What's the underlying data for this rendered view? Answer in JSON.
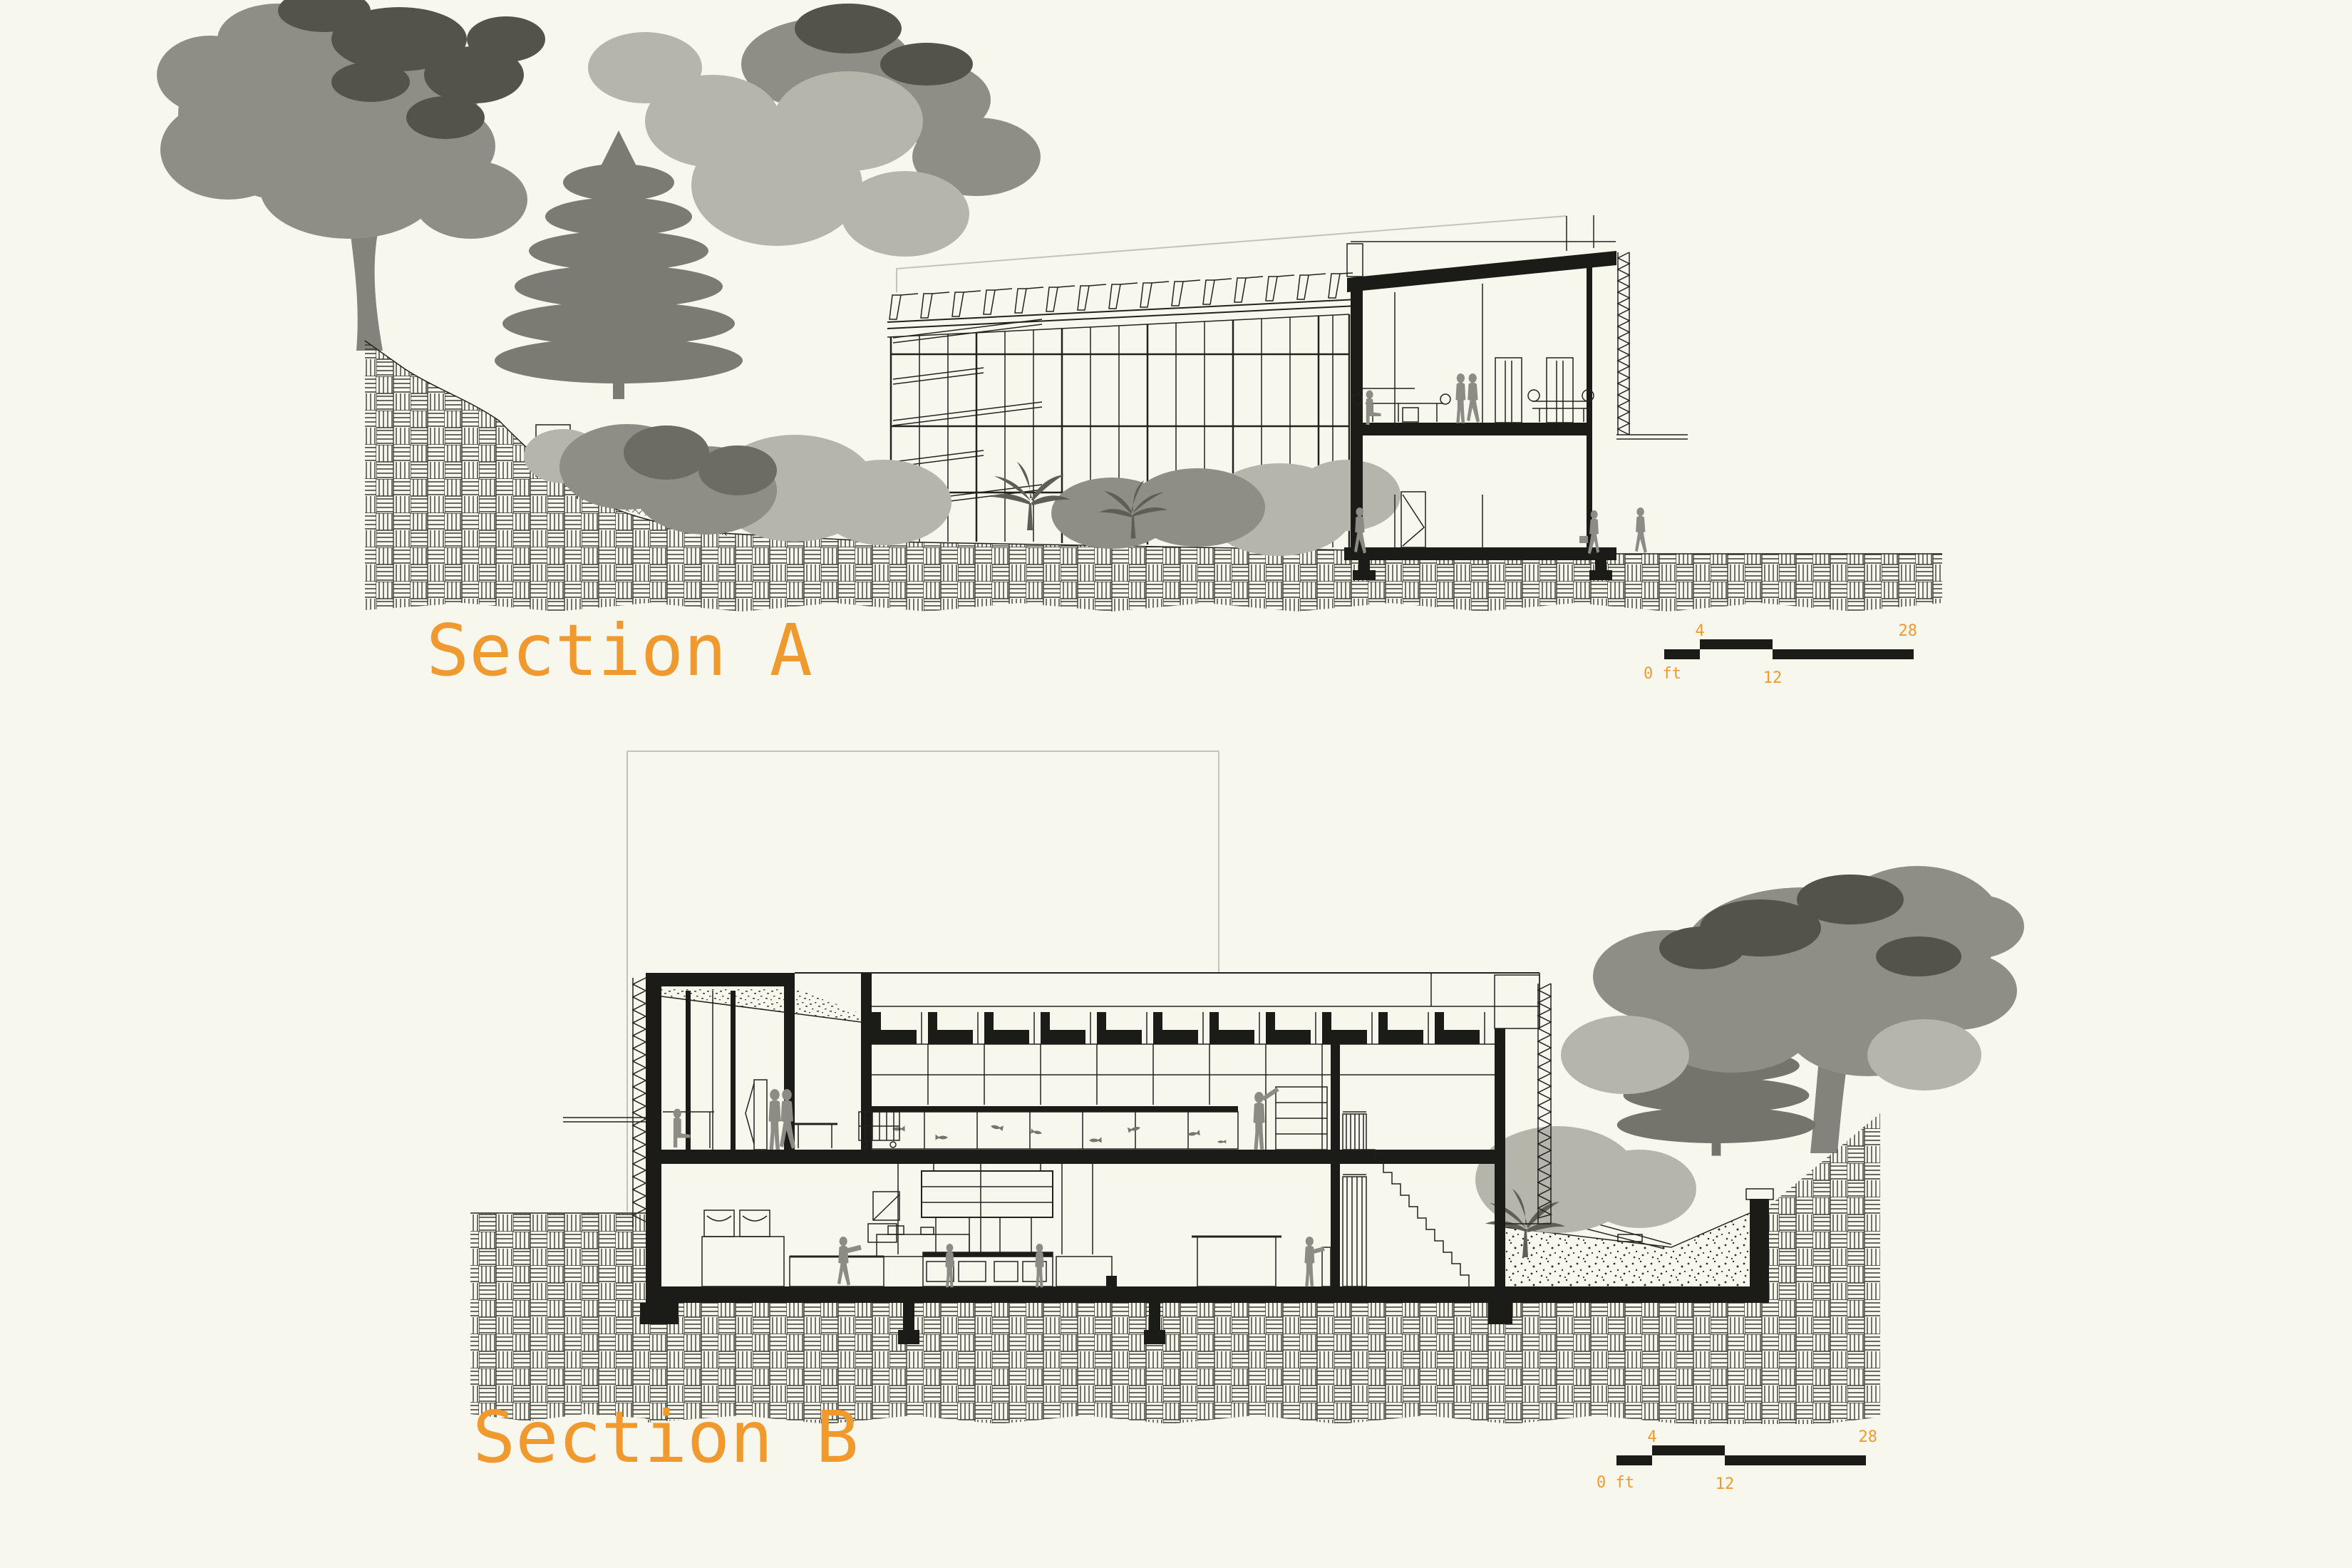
{
  "drawing": {
    "background_color": "#F8F7ED",
    "accent_color": "#F0992F",
    "ink_color": "#1B1B17",
    "sections": [
      {
        "id": "A",
        "label": "Section A"
      },
      {
        "id": "B",
        "label": "Section B"
      }
    ],
    "scale_bar": {
      "zero_label": "0 ft",
      "mid_top_label": "4",
      "mid_bottom_label": "12",
      "end_label": "28"
    }
  }
}
